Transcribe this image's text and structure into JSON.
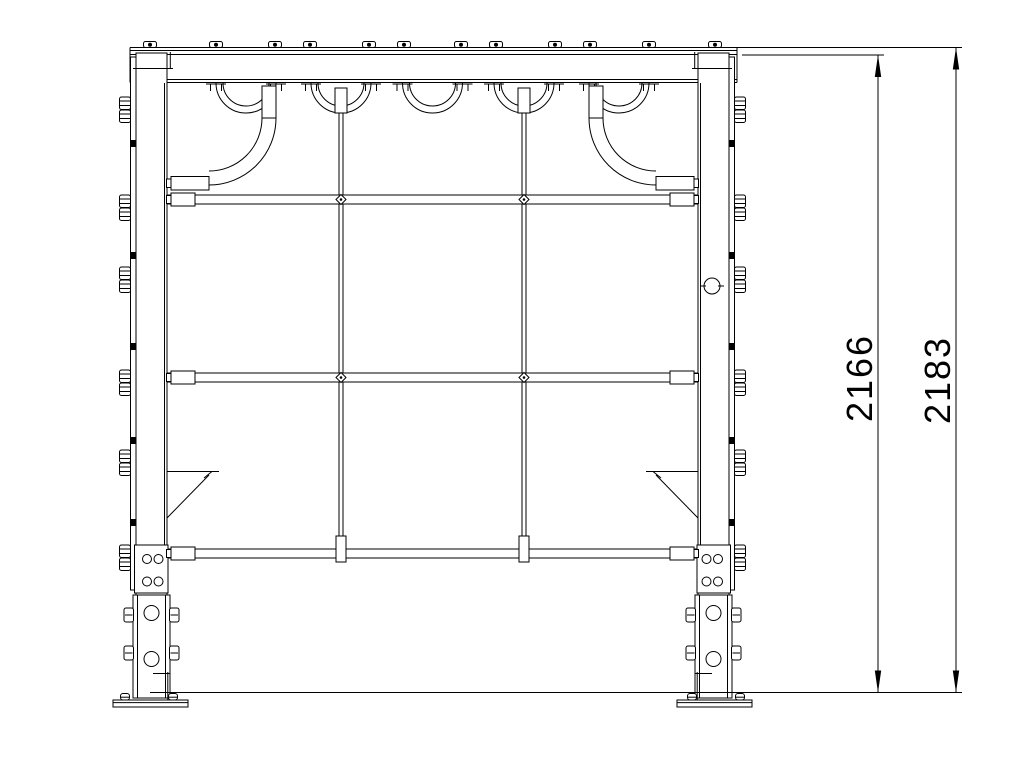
{
  "drawing": {
    "type": "technical-drawing-front-view",
    "background_color": "#ffffff",
    "line_color": "#000000",
    "dimensions": [
      {
        "id": "inner-height",
        "label": "2166"
      },
      {
        "id": "overall-height",
        "label": "2183"
      }
    ]
  },
  "geometry": {
    "beam_bolts_x": [
      150,
      216,
      275,
      310,
      369,
      404,
      461,
      496,
      555,
      590,
      649,
      715
    ],
    "arc_centers_x": [
      246,
      341,
      432.5,
      524,
      619
    ],
    "drop_tubes_x": [
      341,
      524
    ],
    "rails_y": [
      195,
      373,
      549
    ],
    "column_bolt_rows_y": [
      97,
      195,
      267,
      370,
      450,
      545
    ],
    "column_nubs_y": [
      140,
      252,
      343,
      437,
      519
    ]
  }
}
